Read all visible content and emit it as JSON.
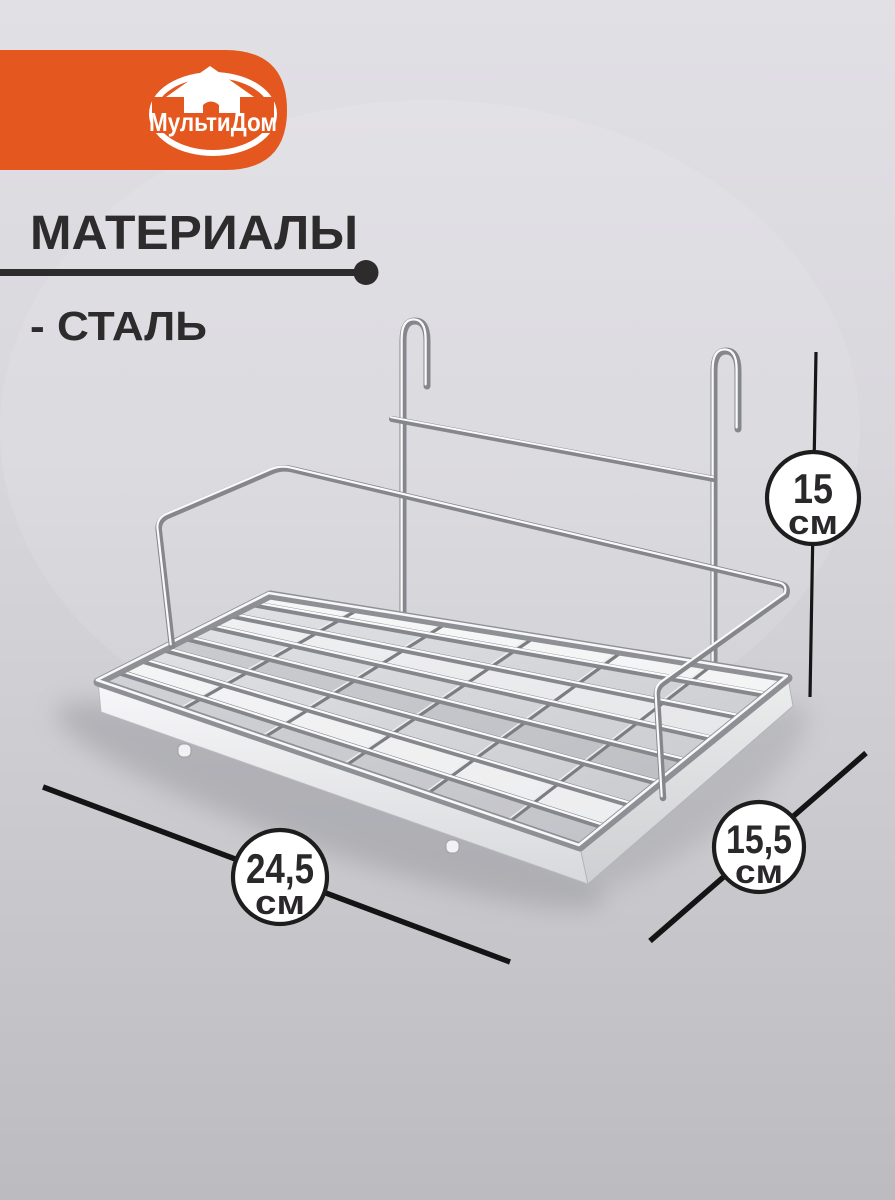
{
  "brand": {
    "name": "МультиДом",
    "banner_color": "#e4571e",
    "logo_icon": "house-in-ring-icon"
  },
  "header": {
    "title": "МАТЕРИАЛЫ",
    "list_item": "- СТАЛЬ"
  },
  "product": {
    "illustration": "chrome-steel-hanging-wire-shelf-with-two-hooks"
  },
  "dimensions": {
    "height": {
      "value": "15",
      "unit": "см"
    },
    "length": {
      "value": "24,5",
      "unit": "см"
    },
    "depth": {
      "value": "15,5",
      "unit": "см"
    }
  },
  "colors": {
    "accent_orange": "#e4571e",
    "heading_text": "#2d2b2c",
    "dimension_line": "#161616",
    "badge_fill": "#ffffff",
    "badge_border": "#1d1d1d",
    "chrome_base": "#85878d",
    "background_top": "#e0dfe4",
    "background_bottom": "#bdbdc1"
  }
}
